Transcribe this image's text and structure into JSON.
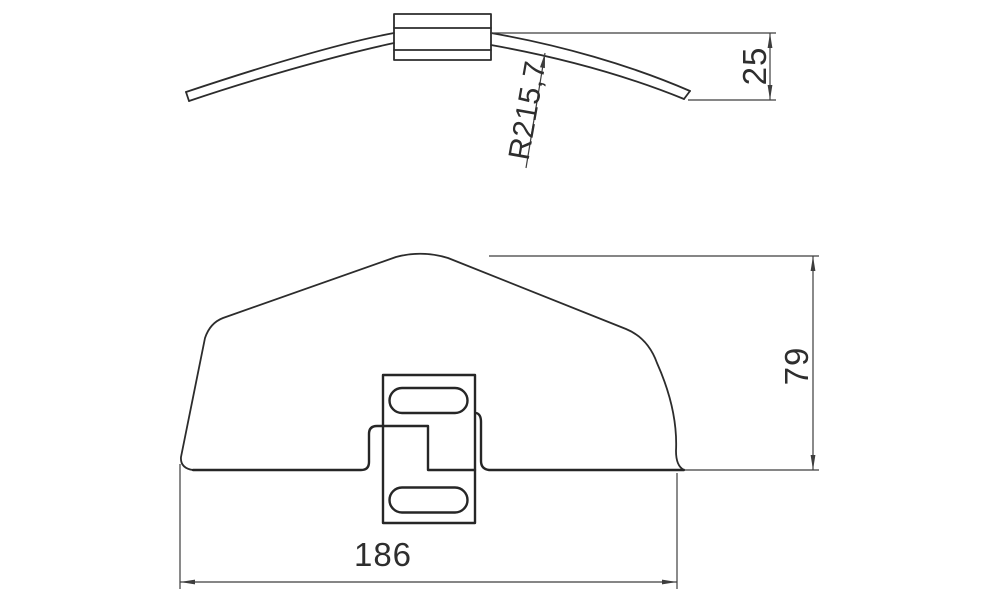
{
  "drawing": {
    "type": "technical-drawing",
    "background_color": "#ffffff",
    "line_color": "#2c2c2c",
    "dimension_color": "#3d3d3d",
    "views": {
      "side_view": {
        "description": "curved strip with center clamp block - side profile",
        "dimensions": {
          "end_offset": "25",
          "radius": "R215,7"
        }
      },
      "front_view": {
        "description": "arched cover with center mounting bracket - front elevation",
        "dimensions": {
          "width": "186",
          "height": "79"
        }
      }
    }
  }
}
